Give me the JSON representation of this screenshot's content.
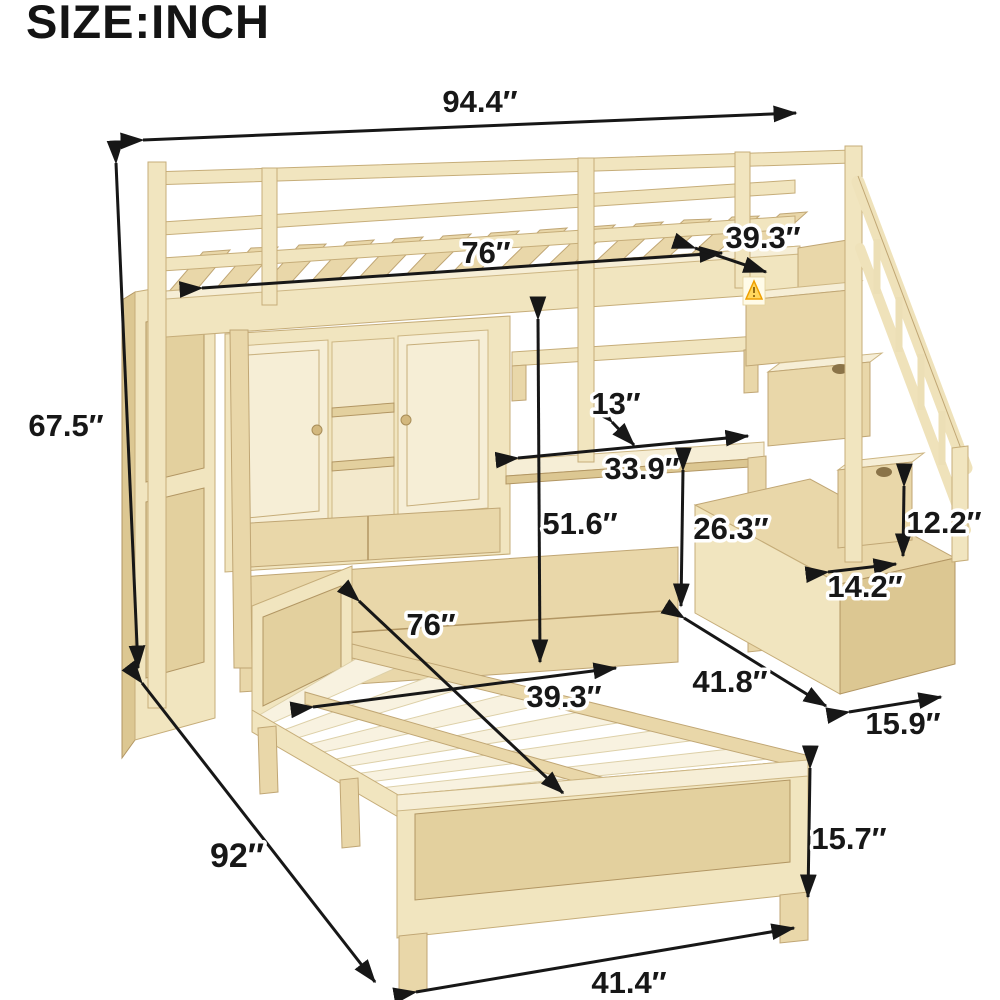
{
  "title": "SIZE:INCH",
  "unit": "inch",
  "colors": {
    "wood_light": "#f1e5bf",
    "wood_medium": "#e9d7a9",
    "wood_dark": "#dcc792",
    "arrow": "#171717",
    "warning_yellow": "#ffd75e",
    "background": "#ffffff"
  },
  "dimensions": {
    "overall_width": "94.4″",
    "overall_height": "67.5″",
    "loft_bed_length": "76″",
    "loft_bed_width": "39.3″",
    "hutch_shelf_depth": "13″",
    "desk_length": "33.9″",
    "under_loft_clearance": "51.6″",
    "desk_height": "26.3″",
    "stair_step_height": "12.2″",
    "stair_step_depth": "14.2″",
    "stair_base_length": "41.8″",
    "stair_base_width": "15.9″",
    "platform_bed_length": "76″",
    "platform_bed_width": "39.3″",
    "overall_depth": "92″",
    "footboard_width": "41.4″",
    "footboard_height": "15.7″"
  }
}
